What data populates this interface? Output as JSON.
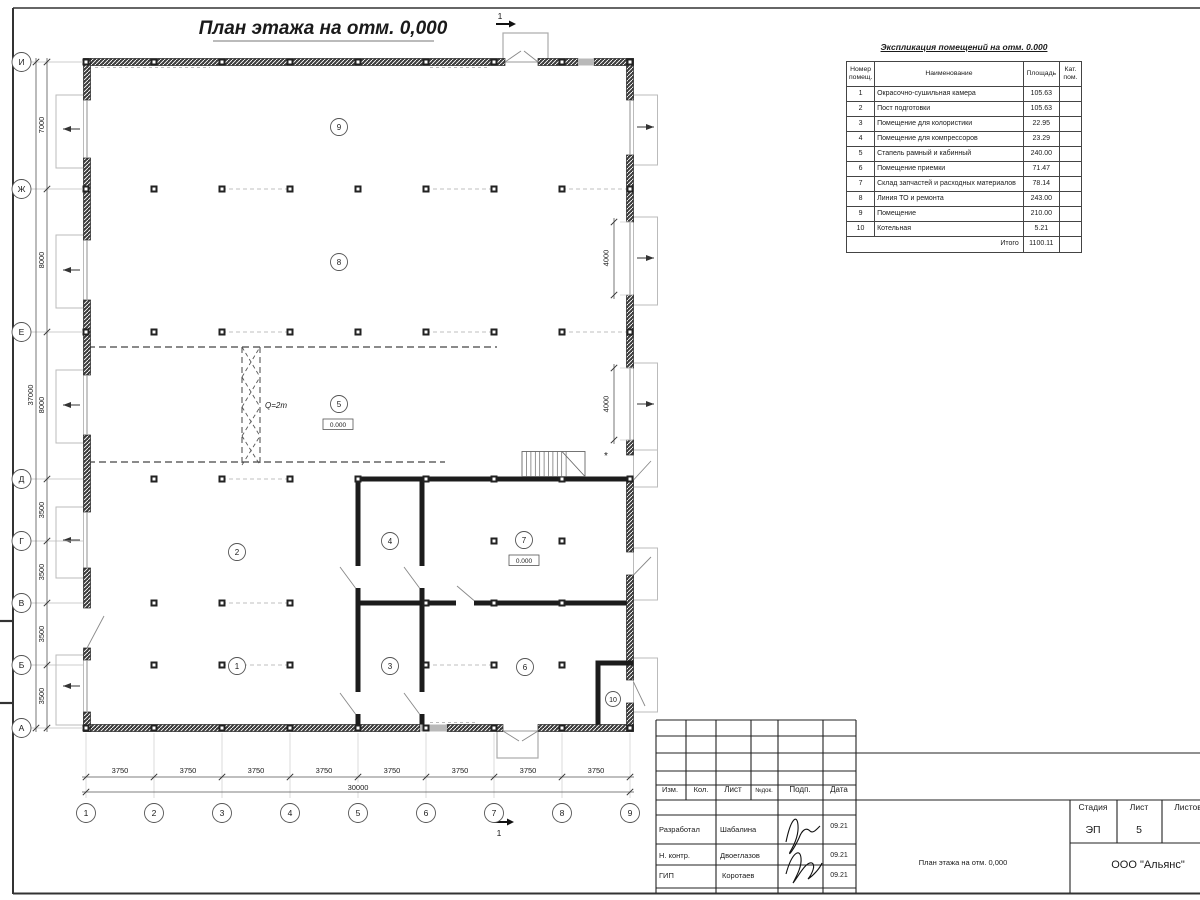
{
  "plan": {
    "title": "План этажа на отм. 0,000",
    "axes_rows": [
      "И",
      "Ж",
      "Е",
      "Д",
      "Г",
      "В",
      "Б",
      "А"
    ],
    "axes_cols": [
      "1",
      "2",
      "3",
      "4",
      "5",
      "6",
      "7",
      "8",
      "9"
    ],
    "dims_left": [
      "7000",
      "8000",
      "8000",
      "3500",
      "3500",
      "3500",
      "3500"
    ],
    "dim_left_total": "37000",
    "dims_bottom": [
      "3750",
      "3750",
      "3750",
      "3750",
      "3750",
      "3750",
      "3750",
      "3750"
    ],
    "dim_bottom_total": "30000",
    "dims_right": [
      "4000",
      "4000"
    ],
    "rooms": [
      "1",
      "2",
      "3",
      "4",
      "5",
      "6",
      "7",
      "8",
      "9",
      "10"
    ],
    "elevations": [
      "0.000",
      "0.000"
    ],
    "crane_load": "Q=2т",
    "section_mark": "1",
    "stair_note": "*"
  },
  "schedule": {
    "title": "Экспликация помещений на отм. 0.000",
    "col_num": "Номер помещ.",
    "col_name": "Наименование",
    "col_area": "Площадь",
    "col_cat": "Кат. пом.",
    "rows": [
      {
        "num": "1",
        "name": "Окрасочно-сушильная камера",
        "area": "105.63",
        "cat": ""
      },
      {
        "num": "2",
        "name": "Пост подготовки",
        "area": "105.63",
        "cat": ""
      },
      {
        "num": "3",
        "name": "Помещение для колористики",
        "area": "22.95",
        "cat": ""
      },
      {
        "num": "4",
        "name": "Помещение для компрессоров",
        "area": "23.29",
        "cat": ""
      },
      {
        "num": "5",
        "name": "Стапель рамный и кабинный",
        "area": "240.00",
        "cat": ""
      },
      {
        "num": "6",
        "name": "Помещение приемки",
        "area": "71.47",
        "cat": ""
      },
      {
        "num": "7",
        "name": "Склад запчастей и расходных материалов",
        "area": "78.14",
        "cat": ""
      },
      {
        "num": "8",
        "name": "Линия ТО и ремонта",
        "area": "243.00",
        "cat": ""
      },
      {
        "num": "9",
        "name": "Помещение",
        "area": "210.00",
        "cat": ""
      },
      {
        "num": "10",
        "name": "Котельная",
        "area": "5.21",
        "cat": ""
      }
    ],
    "total_label": "Итого",
    "total_area": "1100.11"
  },
  "titleblock": {
    "h_izm": "Изм.",
    "h_kol": "Кол.",
    "h_list": "Лист",
    "h_dok": "№док.",
    "h_podp": "Подп.",
    "h_data": "Дата",
    "rows": [
      {
        "role": "Разработал",
        "name": "Шабалина",
        "date": "09.21"
      },
      {
        "role": "Н. контр.",
        "name": "Двоеглазов",
        "date": "09.21"
      },
      {
        "role": "ГИП",
        "name": "Коротаев",
        "date": "09.21"
      }
    ],
    "stage_label": "Стадия",
    "sheet_label": "Лист",
    "sheets_label": "Листов",
    "stage": "ЭП",
    "sheet_num": "5",
    "doc_title": "План этажа на отм. 0,000",
    "company": "ООО \"Альянс\""
  }
}
